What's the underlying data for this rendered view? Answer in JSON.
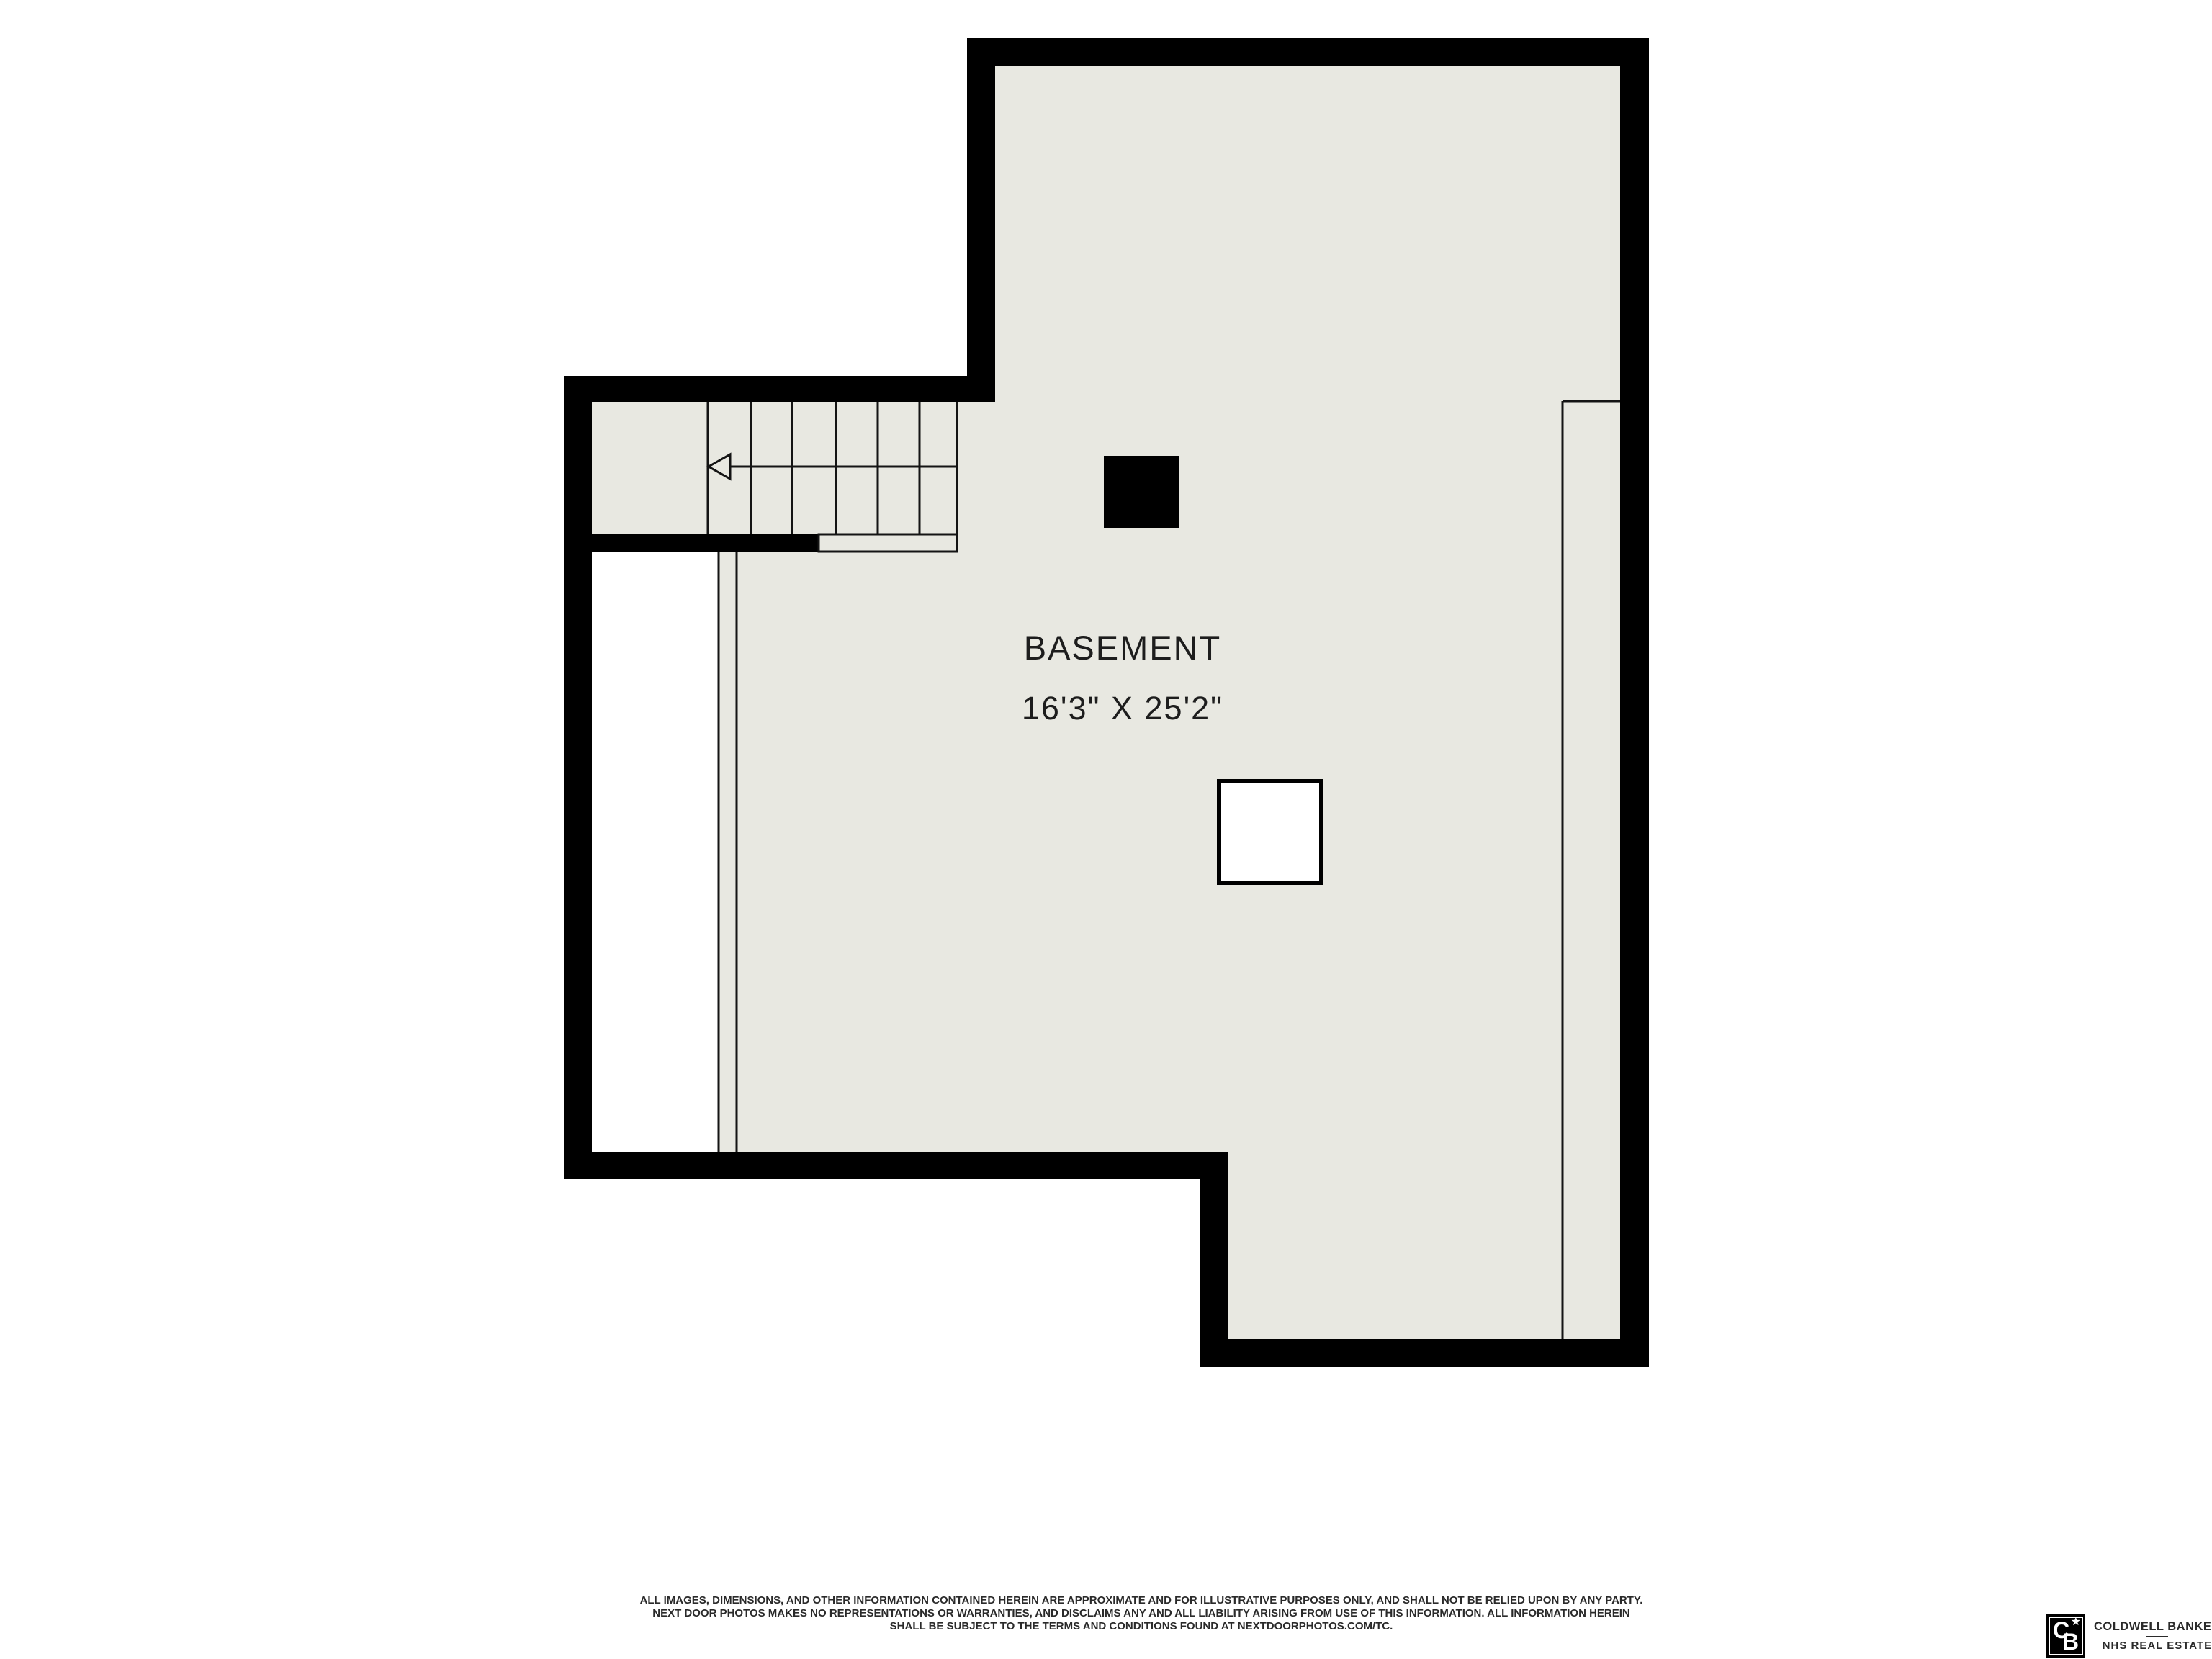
{
  "colors": {
    "wall": "#000000",
    "floor": "#e8e8e1",
    "line": "#141414",
    "ink": "#1d1d1d",
    "muted": "#2a2a2a",
    "paper": "#ffffff"
  },
  "floor_plan": {
    "room_label": "BASEMENT",
    "room_dimensions": "16'3\" X 25'2\"",
    "icons": {
      "stair_direction_arrow": "arrow-left-icon"
    }
  },
  "footer": {
    "disclaimer_line1": "ALL IMAGES, DIMENSIONS, AND OTHER INFORMATION CONTAINED HEREIN ARE APPROXIMATE AND FOR ILLUSTRATIVE PURPOSES ONLY, AND SHALL NOT BE RELIED UPON BY ANY PARTY.",
    "disclaimer_line2": "NEXT DOOR PHOTOS MAKES NO REPRESENTATIONS OR WARRANTIES, AND DISCLAIMS ANY AND ALL LIABILITY ARISING FROM USE OF THIS INFORMATION. ALL INFORMATION HEREIN",
    "disclaimer_line3": "SHALL BE SUBJECT TO THE TERMS AND CONDITIONS FOUND AT NEXTDOORPHOTOS.COM/TC.",
    "brand": {
      "monogram_c": "C",
      "monogram_b": "B",
      "star": "★",
      "name_line1": "COLDWELL BANKER",
      "name_line2": "NHS REAL ESTATE"
    }
  }
}
